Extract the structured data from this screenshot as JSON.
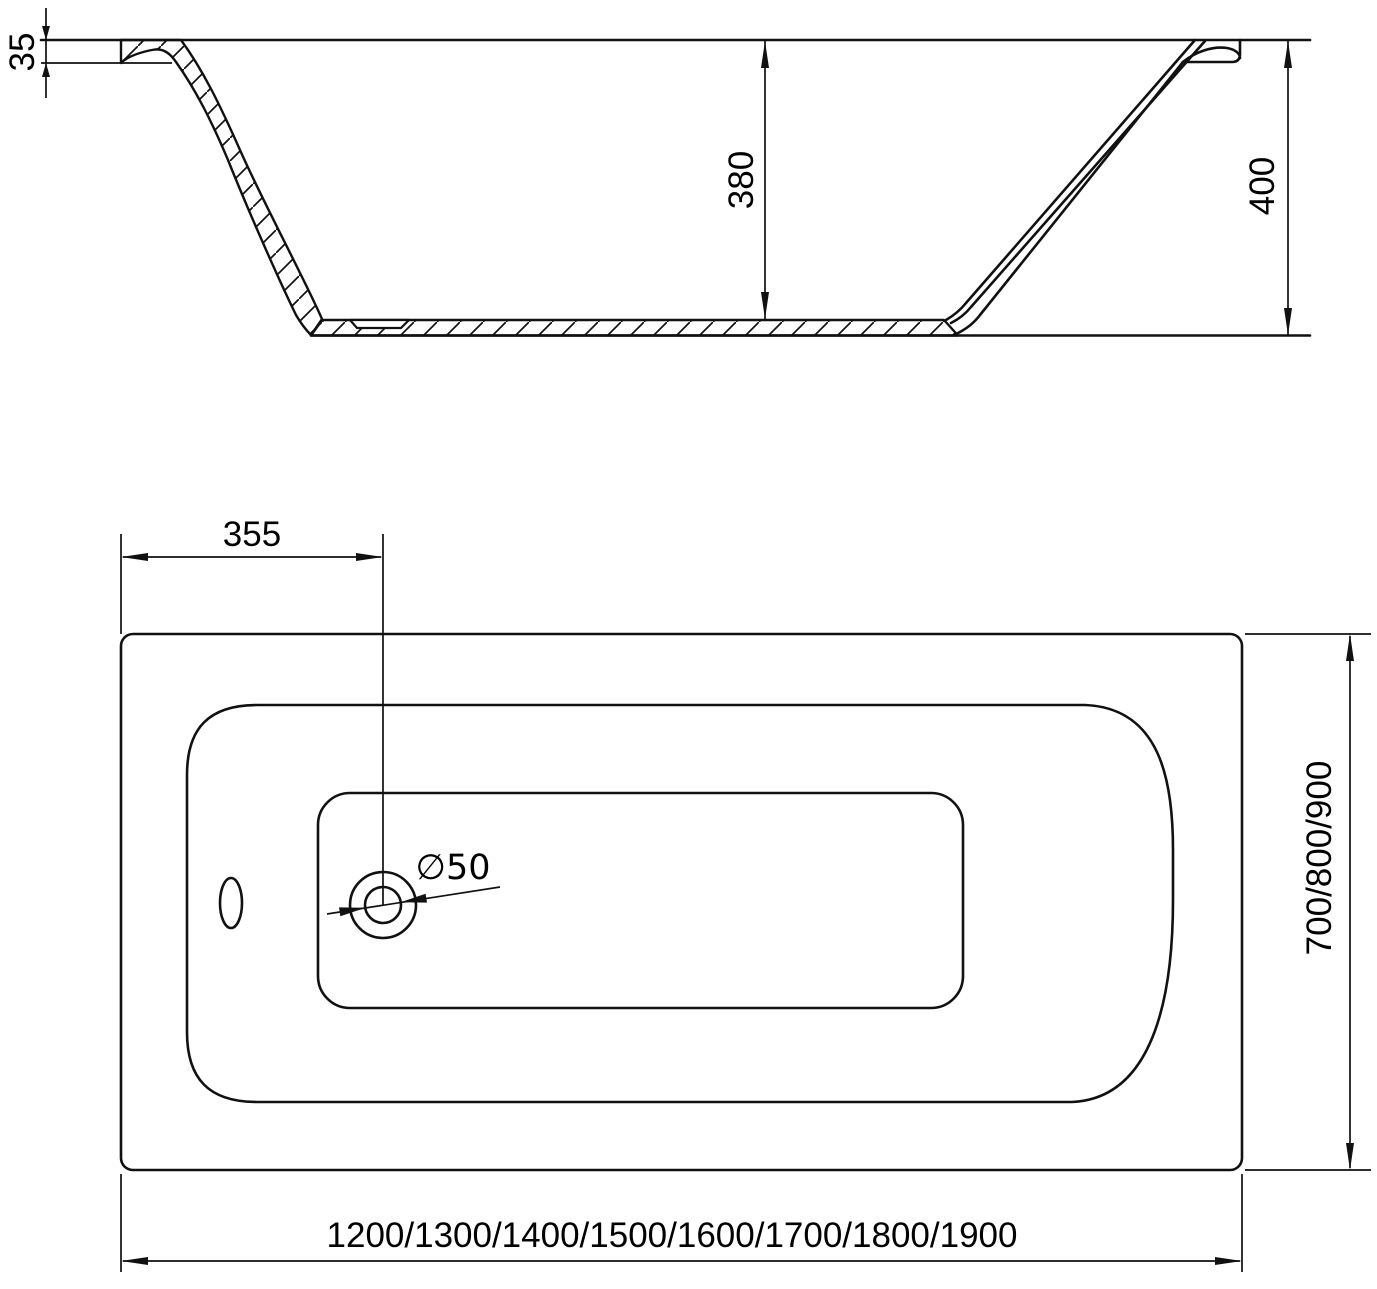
{
  "drawing": {
    "title": "Bathtub technical drawing, section and plan views",
    "side_view": {
      "rim_thickness_label": "35",
      "inner_depth_label": "380",
      "overall_height_label": "400"
    },
    "plan_view": {
      "drain_offset_label": "355",
      "drain_diameter_label": "∅50",
      "width_options_label": "700/800/900",
      "length_options_label": "1200/1300/1400/1500/1600/1700/1800/1900"
    },
    "colors": {
      "line": "#111111",
      "text": "#000000",
      "background": "#ffffff"
    }
  }
}
